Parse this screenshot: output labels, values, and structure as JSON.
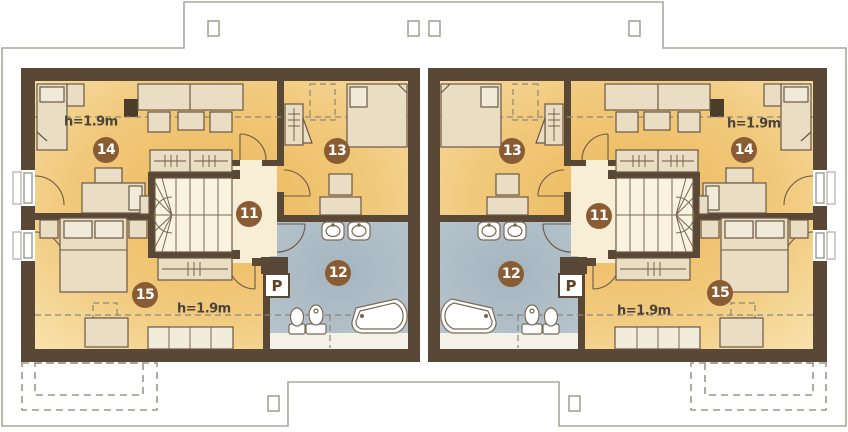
{
  "plan": {
    "kind": "attic floor plan - semi-detached house, two mirrored units",
    "labels": {
      "room_11": "11",
      "room_12": "12",
      "room_13": "13",
      "room_14": "14",
      "room_15": "15",
      "height": "h=1.9m",
      "washer": "P"
    },
    "colors": {
      "wall": "#594836",
      "room_fill": "#eeba5d",
      "room_fill_light": "#f8e3ae",
      "hall_fill": "#f8eed6",
      "stair_fill": "#f9f3e0",
      "bath_fill": "#aab9c2",
      "low_strip_fill": "#f3f1e8",
      "furniture_fill": "#e9ddc4",
      "furniture_stroke": "#6b5845",
      "fixture_fill": "#ffffff",
      "badge": "#8a5c33",
      "badge_text": "#ffffff",
      "label_text": "#49433a",
      "roof_outline": "#a8a89a",
      "dashed_line": "#8a887d",
      "shaft": "#4c3c2c"
    }
  }
}
